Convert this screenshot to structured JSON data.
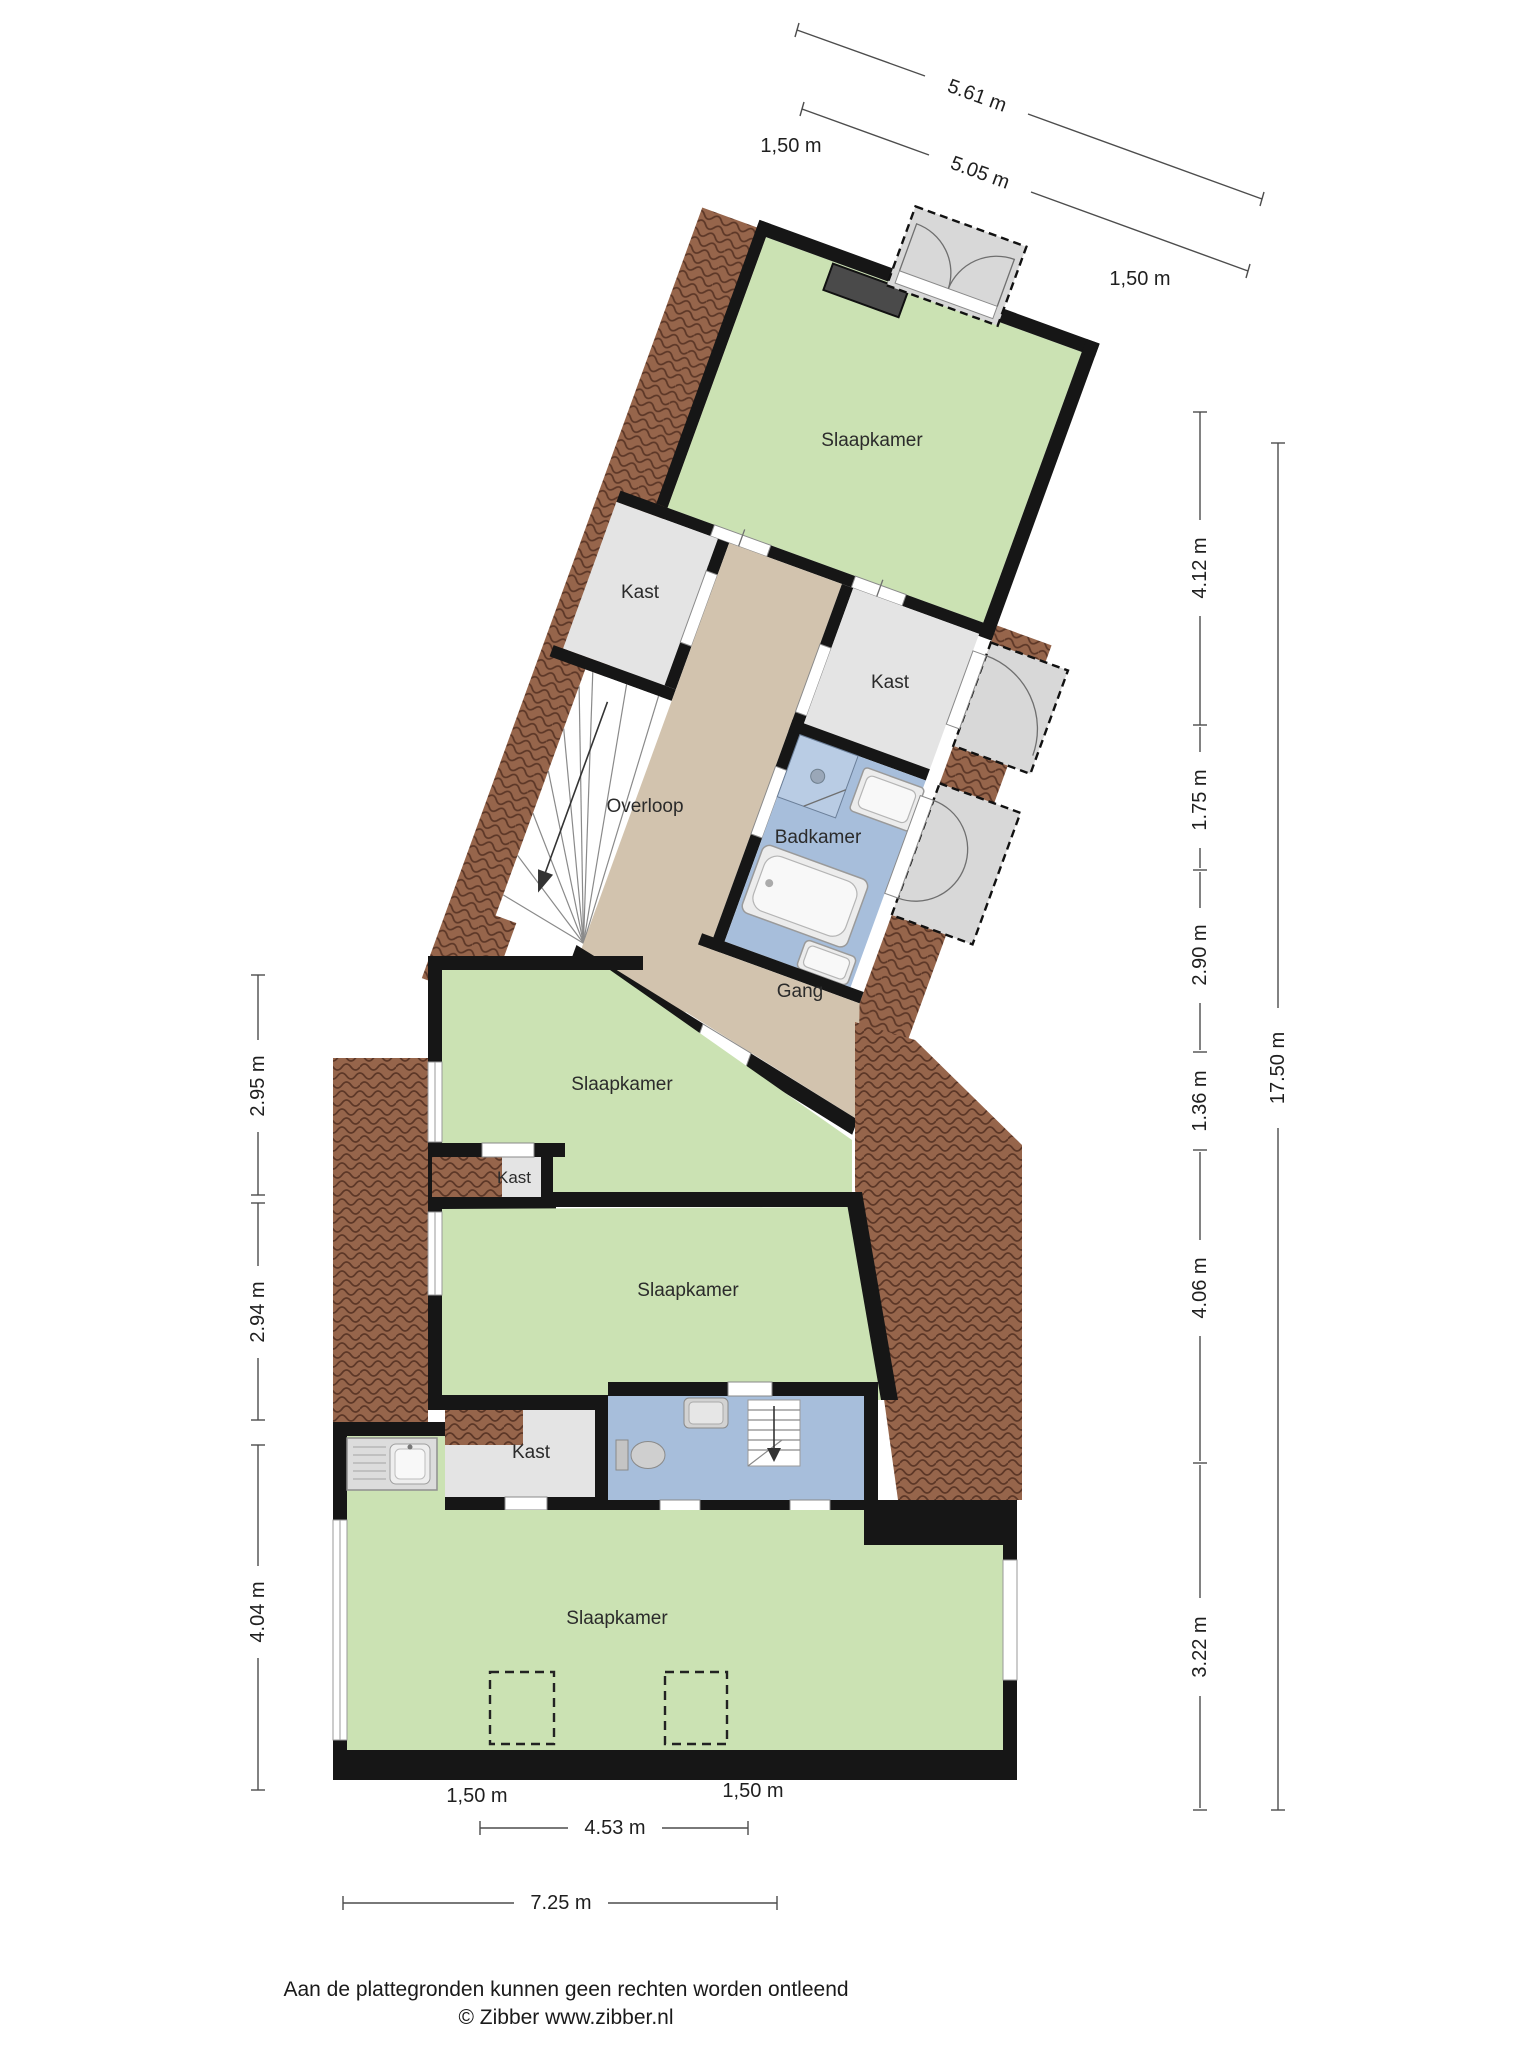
{
  "floorplan": {
    "rooms": {
      "bedroom_top": "Slaapkamer",
      "closet_upper_left": "Kast",
      "closet_upper_right": "Kast",
      "landing": "Overloop",
      "bathroom": "Badkamer",
      "hallway": "Gang",
      "bedroom_middle": "Slaapkamer",
      "closet_middle": "Kast",
      "bedroom_large": "Slaapkamer",
      "closet_bottom": "Kast",
      "bedroom_bottom": "Slaapkamer"
    },
    "dimensions": {
      "top_outer": "5.61 m",
      "top_inner": "5.05 m",
      "top_left_knee": "1,50 m",
      "top_right_knee": "1,50 m",
      "right_1": "4.12 m",
      "right_2": "1.75 m",
      "right_3": "2.90 m",
      "right_4": "1.36 m",
      "right_5": "4.06 m",
      "right_6": "3.22 m",
      "right_total": "17.50 m",
      "left_1": "2.95 m",
      "left_2": "2.94 m",
      "left_3": "4.04 m",
      "bottom_left_knee": "1,50 m",
      "bottom_right_knee": "1,50 m",
      "bottom_inner": "4.53 m",
      "bottom_outer": "7.25 m"
    },
    "footer": {
      "disclaimer": "Aan de plattegronden kunnen geen rechten worden ontleend",
      "copyright": "© Zibber www.zibber.nl"
    },
    "colors": {
      "room_green": "#cbe2b3",
      "room_blue": "#a7bedb",
      "shower_blue": "#b9cce4",
      "hall_tan": "#d2c3ae",
      "closet_gray": "#e4e4e4",
      "wall": "#161616",
      "roof_brown": "#96654b",
      "roof_line": "#5c3727",
      "dormer_gray": "#d8d8d8"
    }
  }
}
